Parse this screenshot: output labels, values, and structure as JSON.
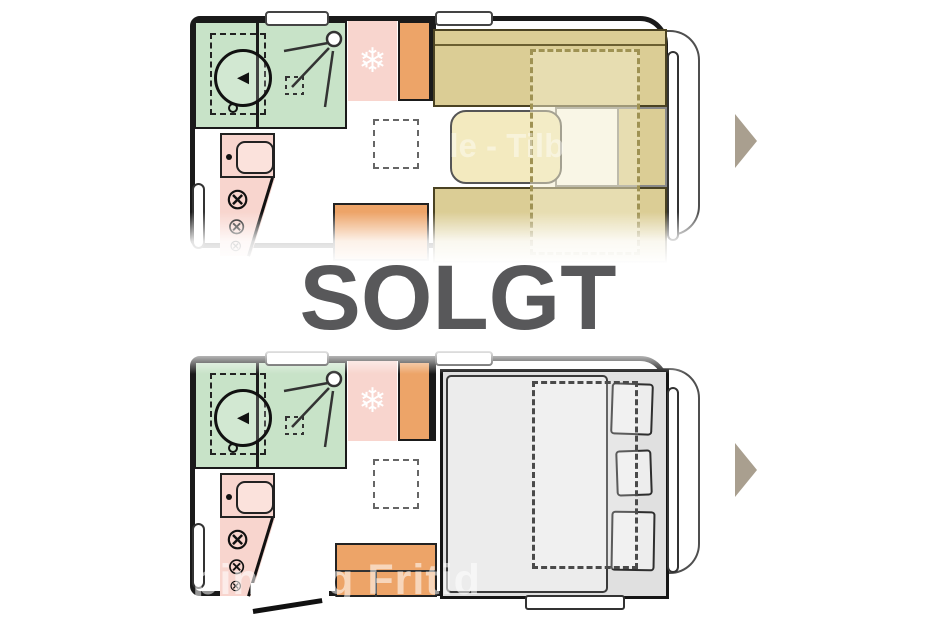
{
  "overlay": {
    "sold_label": "SOLGT"
  },
  "watermarks": {
    "bottom": "Camping og Fritid",
    "top_fragment": "tale - Tilb"
  },
  "icons": {
    "snowflake": "❄",
    "burner": "⊗",
    "toilet_arrow": "◄",
    "next_arrow": "play-triangle-right"
  },
  "colors": {
    "wall": "#1a1a1a",
    "bath_green": "#c8e3c8",
    "pink": "#f8d5ce",
    "pink_light": "#fbe2dc",
    "orange": "#eda468",
    "khaki": "#dbcd95",
    "cream": "#f3eabf",
    "dash_olive": "#9f9253",
    "bed_gray": "#e0e0e0",
    "duvet_gray": "#ececec",
    "pillow_gray": "#ededed",
    "solgt_gray": "#58585a",
    "arrow_taupe": "#a99f8f"
  }
}
